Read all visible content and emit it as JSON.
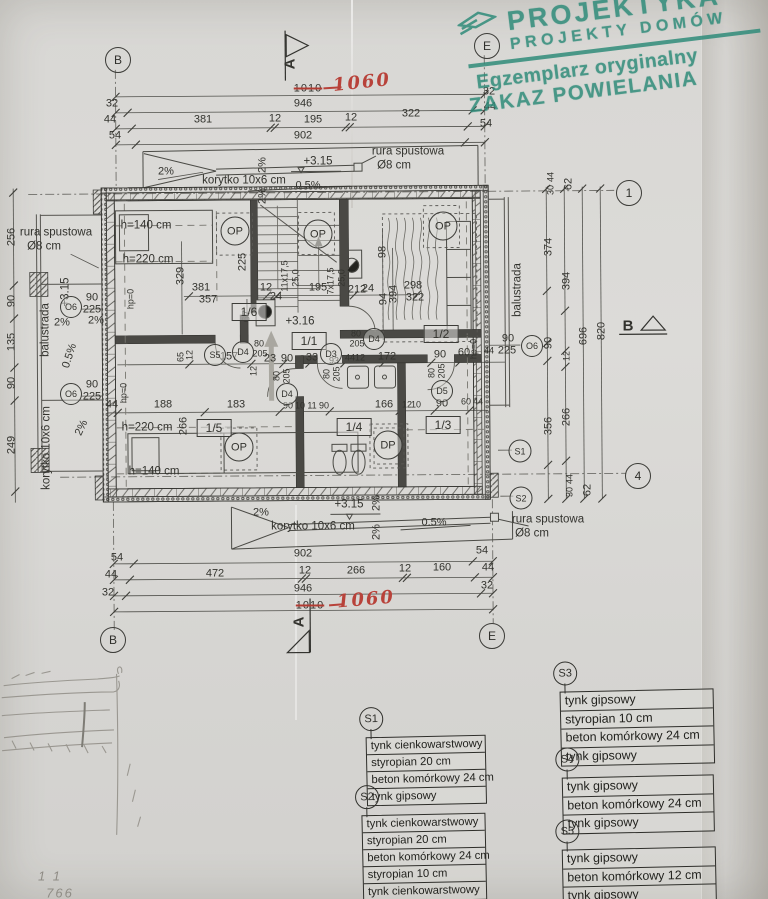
{
  "stamp": {
    "brand": "PROJEKTYKA",
    "brand2": "PROJEKTY  DOMÓW",
    "line1": "Egzemplarz oryginalny",
    "line2": "ZAKAZ POWIELANIA",
    "color": "#2e8b79"
  },
  "axis_markers": [
    {
      "l": "B",
      "x": 118,
      "y": 60
    },
    {
      "l": "E",
      "x": 487,
      "y": 46
    },
    {
      "l": "B",
      "x": 113,
      "y": 640
    },
    {
      "l": "E",
      "x": 492,
      "y": 636
    },
    {
      "l": "1",
      "x": 629,
      "y": 193
    },
    {
      "l": "4",
      "x": 638,
      "y": 476
    }
  ],
  "plan_markers": [
    {
      "l": "OP",
      "x": 235,
      "y": 231,
      "s": 27
    },
    {
      "l": "OP",
      "x": 318,
      "y": 234,
      "s": 27
    },
    {
      "l": "OP",
      "x": 443,
      "y": 226,
      "s": 27
    },
    {
      "l": "OP",
      "x": 239,
      "y": 447,
      "s": 27
    },
    {
      "l": "DP",
      "x": 388,
      "y": 445,
      "s": 27
    },
    {
      "l": "D4",
      "x": 243,
      "y": 352,
      "s": 20
    },
    {
      "l": "D4",
      "x": 287,
      "y": 394,
      "s": 20
    },
    {
      "l": "D3",
      "x": 331,
      "y": 354,
      "s": 20
    },
    {
      "l": "D4",
      "x": 374,
      "y": 339,
      "s": 20
    },
    {
      "l": "D5",
      "x": 442,
      "y": 391,
      "s": 20
    },
    {
      "l": "S5",
      "x": 215,
      "y": 355,
      "s": 20
    },
    {
      "l": "O6",
      "x": 71,
      "y": 307,
      "s": 20
    },
    {
      "l": "O6",
      "x": 71,
      "y": 394,
      "s": 20
    },
    {
      "l": "O6",
      "x": 532,
      "y": 346,
      "s": 20
    },
    {
      "l": "S1",
      "x": 520,
      "y": 451,
      "s": 21
    },
    {
      "l": "S2",
      "x": 521,
      "y": 498,
      "s": 21
    }
  ],
  "legend": [
    {
      "id": "S1",
      "x": 366,
      "y": 706,
      "w": 118,
      "fs": "11.3px",
      "rows": [
        "tynk cienkowarstwowy",
        "styropian 20 cm",
        "beton komórkowy 24 cm",
        "tynk gipsowy"
      ]
    },
    {
      "id": "S2",
      "x": 362,
      "y": 784,
      "w": 122,
      "fs": "11.3px",
      "rows": [
        "tynk cienkowarstwowy",
        "styropian 20 cm",
        "beton komórkowy 24 cm",
        "styropian 10 cm",
        "tynk cienkowarstwowy"
      ]
    },
    {
      "id": "S3",
      "x": 560,
      "y": 660,
      "w": 152,
      "fs": "12.4px",
      "rows": [
        "tynk gipsowy",
        "styropian 10 cm",
        "beton komórkowy 24 cm",
        "tynk gipsowy"
      ]
    },
    {
      "id": "S4",
      "x": 562,
      "y": 746,
      "w": 150,
      "fs": "12.4px",
      "rows": [
        "tynk gipsowy",
        "beton komórkowy 24 cm",
        "tynk gipsowy"
      ]
    },
    {
      "id": "S5",
      "x": 562,
      "y": 818,
      "w": 152,
      "fs": "12.4px",
      "rows": [
        "tynk gipsowy",
        "beton komórkowy 12 cm",
        "tynk gipsowy"
      ]
    }
  ],
  "annotations": [
    {
      "t": "1010",
      "x": 308,
      "y": 89,
      "c": "strike"
    },
    {
      "t": "1060",
      "x": 362,
      "y": 83,
      "c": "red",
      "r": -6
    },
    {
      "t": "946",
      "x": 303,
      "y": 104
    },
    {
      "t": "32",
      "x": 112,
      "y": 104
    },
    {
      "t": "44",
      "x": 110,
      "y": 120
    },
    {
      "t": "381",
      "x": 203,
      "y": 120
    },
    {
      "t": "12",
      "x": 275,
      "y": 119
    },
    {
      "t": "195",
      "x": 313,
      "y": 120
    },
    {
      "t": "12",
      "x": 351,
      "y": 118
    },
    {
      "t": "322",
      "x": 411,
      "y": 114
    },
    {
      "t": "54",
      "x": 115,
      "y": 136
    },
    {
      "t": "902",
      "x": 303,
      "y": 136
    },
    {
      "t": "32",
      "x": 489,
      "y": 92
    },
    {
      "t": "44",
      "x": 490,
      "y": 107
    },
    {
      "t": "54",
      "x": 486,
      "y": 124
    },
    {
      "t": "2%",
      "x": 166,
      "y": 172
    },
    {
      "t": "korytko 10x6 cm",
      "x": 244,
      "y": 181,
      "c": "md"
    },
    {
      "t": "2%",
      "x": 263,
      "y": 165,
      "r": -90
    },
    {
      "t": "2%",
      "x": 263,
      "y": 196,
      "r": -90
    },
    {
      "t": "+3.15",
      "x": 318,
      "y": 162,
      "c": "md"
    },
    {
      "t": "0.5%",
      "x": 308,
      "y": 186
    },
    {
      "t": "rura spustowa",
      "x": 408,
      "y": 152,
      "c": "md"
    },
    {
      "t": "Ø8 cm",
      "x": 394,
      "y": 166,
      "c": "md"
    },
    {
      "t": "rura spustowa",
      "x": 56,
      "y": 233,
      "c": "md"
    },
    {
      "t": "Ø8 cm",
      "x": 44,
      "y": 247,
      "c": "md"
    },
    {
      "t": "256",
      "x": 12,
      "y": 237,
      "r": -90
    },
    {
      "t": "90",
      "x": 12,
      "y": 301,
      "r": -90
    },
    {
      "t": "135",
      "x": 12,
      "y": 342,
      "r": -90
    },
    {
      "t": "90",
      "x": 12,
      "y": 383,
      "r": -90
    },
    {
      "t": "249",
      "x": 12,
      "y": 445,
      "r": -90
    },
    {
      "t": "+3.15",
      "x": 66,
      "y": 292,
      "r": -90,
      "c": "md"
    },
    {
      "t": "balustrada",
      "x": 46,
      "y": 330,
      "r": -90,
      "c": "md"
    },
    {
      "t": "90",
      "x": 92,
      "y": 298
    },
    {
      "t": "225",
      "x": 92,
      "y": 310
    },
    {
      "t": "2%",
      "x": 62,
      "y": 323
    },
    {
      "t": "2%",
      "x": 96,
      "y": 321
    },
    {
      "t": "0.5%",
      "x": 70,
      "y": 356,
      "r": -72
    },
    {
      "t": "90",
      "x": 92,
      "y": 385
    },
    {
      "t": "225",
      "x": 92,
      "y": 397
    },
    {
      "t": "korytko 10x6 cm",
      "x": 47,
      "y": 448,
      "r": -90,
      "c": "md"
    },
    {
      "t": "2%",
      "x": 82,
      "y": 428,
      "r": -65
    },
    {
      "t": "h=140 cm",
      "x": 146,
      "y": 226,
      "c": "md"
    },
    {
      "t": "h=220 cm",
      "x": 148,
      "y": 260,
      "c": "md"
    },
    {
      "t": "225",
      "x": 243,
      "y": 262,
      "r": -90
    },
    {
      "t": "329",
      "x": 181,
      "y": 276,
      "r": -90
    },
    {
      "t": "381",
      "x": 201,
      "y": 288
    },
    {
      "t": "357",
      "x": 208,
      "y": 300
    },
    {
      "t": "12",
      "x": 266,
      "y": 288
    },
    {
      "t": "24",
      "x": 276,
      "y": 297
    },
    {
      "t": "67",
      "x": 247,
      "y": 316,
      "r": -90
    },
    {
      "t": "+3.16",
      "x": 300,
      "y": 322,
      "c": "md"
    },
    {
      "t": "11x17,5",
      "x": 285,
      "y": 276,
      "r": -90,
      "c": "sm"
    },
    {
      "t": "25,0",
      "x": 296,
      "y": 278,
      "r": -90,
      "c": "sm"
    },
    {
      "t": "195",
      "x": 318,
      "y": 288
    },
    {
      "t": "7x17,5",
      "x": 331,
      "y": 281,
      "r": -90,
      "c": "sm"
    },
    {
      "t": "25,0",
      "x": 342,
      "y": 278,
      "r": -90,
      "c": "sm"
    },
    {
      "t": "212",
      "x": 357,
      "y": 290
    },
    {
      "t": "24",
      "x": 368,
      "y": 289
    },
    {
      "t": "98",
      "x": 383,
      "y": 252,
      "r": -90
    },
    {
      "t": "94",
      "x": 384,
      "y": 299,
      "r": -90
    },
    {
      "t": "394",
      "x": 394,
      "y": 294,
      "r": -90
    },
    {
      "t": "298",
      "x": 413,
      "y": 286
    },
    {
      "t": "322",
      "x": 415,
      "y": 298
    },
    {
      "t": "hp=0",
      "x": 131,
      "y": 299,
      "r": -90,
      "c": "sm"
    },
    {
      "t": "1/6",
      "x": 249,
      "y": 312,
      "c": "room"
    },
    {
      "t": "1/1",
      "x": 309,
      "y": 341,
      "c": "room"
    },
    {
      "t": "1/2",
      "x": 441,
      "y": 334,
      "c": "room"
    },
    {
      "t": "1/5",
      "x": 214,
      "y": 428,
      "c": "room"
    },
    {
      "t": "1/4",
      "x": 354,
      "y": 427,
      "c": "room"
    },
    {
      "t": "1/3",
      "x": 443,
      "y": 425,
      "c": "room"
    },
    {
      "t": "65",
      "x": 181,
      "y": 357,
      "r": -90,
      "c": "sm"
    },
    {
      "t": "12",
      "x": 190,
      "y": 355,
      "r": -90,
      "c": "sm"
    },
    {
      "t": "80",
      "x": 259,
      "y": 344,
      "c": "sm"
    },
    {
      "t": "205",
      "x": 260,
      "y": 354,
      "c": "sm"
    },
    {
      "t": "157",
      "x": 229,
      "y": 357
    },
    {
      "t": "23",
      "x": 270,
      "y": 359
    },
    {
      "t": "12",
      "x": 254,
      "y": 371,
      "r": -90,
      "c": "sm"
    },
    {
      "t": "90",
      "x": 287,
      "y": 359
    },
    {
      "t": "33",
      "x": 312,
      "y": 358
    },
    {
      "t": "93",
      "x": 334,
      "y": 361,
      "c": "sm"
    },
    {
      "t": "44",
      "x": 350,
      "y": 358,
      "c": "sm"
    },
    {
      "t": "12",
      "x": 360,
      "y": 358,
      "c": "sm"
    },
    {
      "t": "172",
      "x": 387,
      "y": 357
    },
    {
      "t": "90",
      "x": 440,
      "y": 355
    },
    {
      "t": "60",
      "x": 464,
      "y": 353
    },
    {
      "t": "hp=0",
      "x": 474,
      "y": 349,
      "r": -90,
      "c": "sm"
    },
    {
      "t": "44",
      "x": 489,
      "y": 351,
      "c": "sm"
    },
    {
      "t": "90",
      "x": 508,
      "y": 339
    },
    {
      "t": "225",
      "x": 507,
      "y": 351
    },
    {
      "t": "80",
      "x": 356,
      "y": 334,
      "c": "sm"
    },
    {
      "t": "205",
      "x": 357,
      "y": 344,
      "c": "sm"
    },
    {
      "t": "80",
      "x": 327,
      "y": 374,
      "r": -90,
      "c": "sm"
    },
    {
      "t": "205",
      "x": 337,
      "y": 374,
      "r": -90,
      "c": "sm"
    },
    {
      "t": "80",
      "x": 277,
      "y": 376,
      "r": -90,
      "c": "sm"
    },
    {
      "t": "205",
      "x": 287,
      "y": 376,
      "r": -90,
      "c": "sm"
    },
    {
      "t": "80",
      "x": 432,
      "y": 373,
      "r": -90,
      "c": "sm"
    },
    {
      "t": "205",
      "x": 442,
      "y": 371,
      "r": -90,
      "c": "sm"
    },
    {
      "t": "44",
      "x": 112,
      "y": 405
    },
    {
      "t": "hp=0",
      "x": 124,
      "y": 393,
      "r": -90,
      "c": "sm"
    },
    {
      "t": "188",
      "x": 163,
      "y": 405
    },
    {
      "t": "183",
      "x": 236,
      "y": 405
    },
    {
      "t": "90",
      "x": 288,
      "y": 406,
      "c": "sm"
    },
    {
      "t": "10",
      "x": 300,
      "y": 406,
      "c": "sm"
    },
    {
      "t": "11",
      "x": 312,
      "y": 406,
      "c": "sm"
    },
    {
      "t": "90",
      "x": 324,
      "y": 406,
      "c": "sm"
    },
    {
      "t": "166",
      "x": 384,
      "y": 405
    },
    {
      "t": "12",
      "x": 407,
      "y": 405,
      "c": "sm"
    },
    {
      "t": "10",
      "x": 416,
      "y": 405,
      "c": "sm"
    },
    {
      "t": "90",
      "x": 442,
      "y": 404
    },
    {
      "t": "60",
      "x": 466,
      "y": 402,
      "c": "sm"
    },
    {
      "t": "44",
      "x": 478,
      "y": 402,
      "c": "sm"
    },
    {
      "t": "266",
      "x": 184,
      "y": 426,
      "r": -90
    },
    {
      "t": "h=220 cm",
      "x": 147,
      "y": 428,
      "c": "md"
    },
    {
      "t": "h=140 cm",
      "x": 154,
      "y": 472,
      "c": "md"
    },
    {
      "t": "2%",
      "x": 261,
      "y": 513
    },
    {
      "t": "+3.15",
      "x": 349,
      "y": 505,
      "c": "md"
    },
    {
      "t": "2%",
      "x": 377,
      "y": 503,
      "r": -90
    },
    {
      "t": "2%",
      "x": 377,
      "y": 532,
      "r": -90
    },
    {
      "t": "korytko 10x6 cm",
      "x": 313,
      "y": 527,
      "c": "md"
    },
    {
      "t": "0.5%",
      "x": 434,
      "y": 523
    },
    {
      "t": "rura spustowa",
      "x": 548,
      "y": 520,
      "c": "md"
    },
    {
      "t": "Ø8 cm",
      "x": 532,
      "y": 534,
      "c": "md"
    },
    {
      "t": "902",
      "x": 303,
      "y": 554
    },
    {
      "t": "54",
      "x": 117,
      "y": 558
    },
    {
      "t": "54",
      "x": 482,
      "y": 551
    },
    {
      "t": "472",
      "x": 215,
      "y": 574
    },
    {
      "t": "12",
      "x": 305,
      "y": 571
    },
    {
      "t": "266",
      "x": 356,
      "y": 571
    },
    {
      "t": "12",
      "x": 405,
      "y": 569
    },
    {
      "t": "160",
      "x": 442,
      "y": 568
    },
    {
      "t": "44",
      "x": 111,
      "y": 575
    },
    {
      "t": "44",
      "x": 488,
      "y": 568
    },
    {
      "t": "946",
      "x": 303,
      "y": 589
    },
    {
      "t": "32",
      "x": 108,
      "y": 593
    },
    {
      "t": "32",
      "x": 487,
      "y": 586
    },
    {
      "t": "1010",
      "x": 310,
      "y": 606,
      "c": "strike"
    },
    {
      "t": "1060",
      "x": 366,
      "y": 600,
      "c": "red",
      "r": -5
    },
    {
      "t": "44",
      "x": 551,
      "y": 177,
      "r": -90,
      "c": "sm"
    },
    {
      "t": "30",
      "x": 551,
      "y": 190,
      "r": -90,
      "c": "sm"
    },
    {
      "t": "62",
      "x": 569,
      "y": 184,
      "r": -90
    },
    {
      "t": "374",
      "x": 549,
      "y": 247,
      "r": -90
    },
    {
      "t": "394",
      "x": 567,
      "y": 281,
      "r": -90
    },
    {
      "t": "696",
      "x": 584,
      "y": 336,
      "r": -90
    },
    {
      "t": "820",
      "x": 602,
      "y": 331,
      "r": -90
    },
    {
      "t": "90",
      "x": 549,
      "y": 343,
      "r": -90
    },
    {
      "t": "12",
      "x": 567,
      "y": 356,
      "r": -90,
      "c": "sm"
    },
    {
      "t": "balustrada",
      "x": 518,
      "y": 290,
      "r": -90,
      "c": "md"
    },
    {
      "t": "356",
      "x": 549,
      "y": 426,
      "r": -90
    },
    {
      "t": "266",
      "x": 567,
      "y": 417,
      "r": -90
    },
    {
      "t": "44",
      "x": 570,
      "y": 479,
      "r": -90,
      "c": "sm"
    },
    {
      "t": "30",
      "x": 570,
      "y": 492,
      "r": -90,
      "c": "sm"
    },
    {
      "t": "62",
      "x": 588,
      "y": 490,
      "r": -90
    },
    {
      "t": "A",
      "x": 290,
      "y": 64,
      "r": -90,
      "c": "big"
    },
    {
      "t": "A",
      "x": 299,
      "y": 622,
      "r": -90,
      "c": "big"
    },
    {
      "t": "B",
      "x": 628,
      "y": 326,
      "c": "big"
    },
    {
      "t": "1 1",
      "x": 50,
      "y": 876,
      "c": "pencil"
    },
    {
      "t": "766",
      "x": 60,
      "y": 893,
      "c": "pencil"
    }
  ]
}
